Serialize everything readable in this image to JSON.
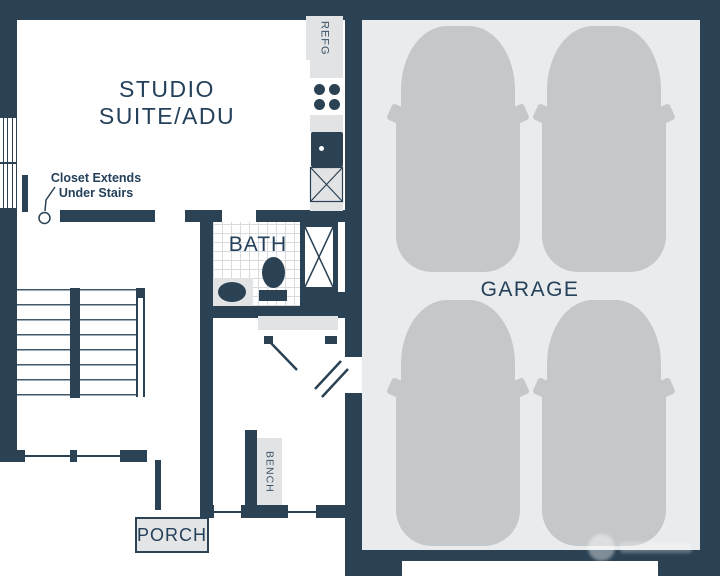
{
  "plan": {
    "title": "Studio suite / ADU with 4-car garage floor plan",
    "studio": {
      "line1": "STUDIO",
      "line2": "SUITE/ADU"
    },
    "closet_note": {
      "line1": "Closet Extends",
      "line2": "Under Stairs"
    },
    "bath": {
      "label": "BATH"
    },
    "garage": {
      "label": "GARAGE",
      "car_count": 4
    },
    "porch": {
      "label": "PORCH"
    },
    "kitchen": {
      "refrigerator_label": "REFG",
      "burner_count": 4
    },
    "entry": {
      "bench_label": "BENCH"
    },
    "colors": {
      "wall": "#2a4254",
      "text": "#24405a",
      "counter_gray": "#e2e3e4",
      "garage_floor": "#e9ebec",
      "car_gray": "#c5c8ca",
      "tile_line": "#d9dcde"
    }
  }
}
